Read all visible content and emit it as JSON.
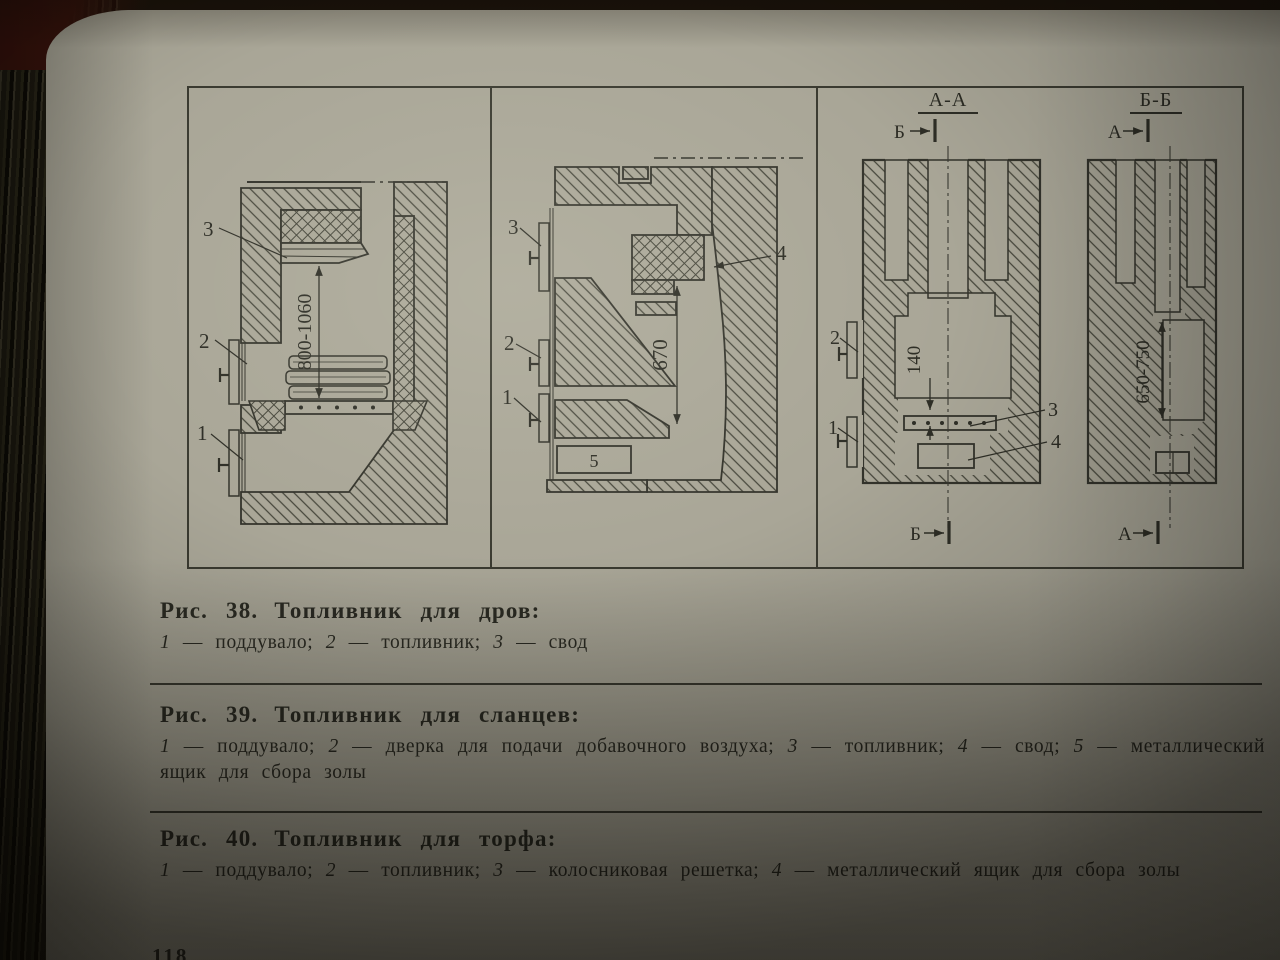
{
  "page": {
    "partial_page_number": "118"
  },
  "figure": {
    "panel1": {
      "dim": "800-1060",
      "label1": "1",
      "label2": "2",
      "label3": "3"
    },
    "panel2": {
      "dim": "670",
      "label1": "1",
      "label2": "2",
      "label3": "3",
      "label4": "4",
      "label5": "5"
    },
    "panel3": {
      "sectionA": {
        "title": "А-А",
        "marker_top": "Б",
        "marker_bottom": "Б",
        "dim": "140",
        "label1": "1",
        "label2": "2",
        "label3": "3",
        "label4": "4"
      },
      "sectionB": {
        "title": "Б-Б",
        "marker_top": "А",
        "marker_bottom": "А",
        "dim": "650-750"
      }
    }
  },
  "captions": {
    "fig38": {
      "ref": "Рис. 38.",
      "title": "Топливник для дров:",
      "legend": [
        {
          "num": "1",
          "text": " — поддувало;  "
        },
        {
          "num": "2",
          "text": " — топливник;  "
        },
        {
          "num": "3",
          "text": " — свод"
        }
      ]
    },
    "fig39": {
      "ref": "Рис. 39.",
      "title": "Топливник для сланцев:",
      "legend": [
        {
          "num": "1",
          "text": " — поддувало;  "
        },
        {
          "num": "2",
          "text": " — дверка для подачи добавочного воздуха;  "
        },
        {
          "num": "3",
          "text": " — топливник;  "
        },
        {
          "num": "4",
          "text": " — свод;  "
        },
        {
          "num": "5",
          "text": " — металлический ящик для сбора золы"
        }
      ]
    },
    "fig40": {
      "ref": "Рис. 40.",
      "title": "Топливник для торфа:",
      "legend": [
        {
          "num": "1",
          "text": " — поддувало;  "
        },
        {
          "num": "2",
          "text": " — топливник;  "
        },
        {
          "num": "3",
          "text": " — колосниковая решетка;  "
        },
        {
          "num": "4",
          "text": " — металлический ящик для сбора золы"
        }
      ]
    }
  }
}
